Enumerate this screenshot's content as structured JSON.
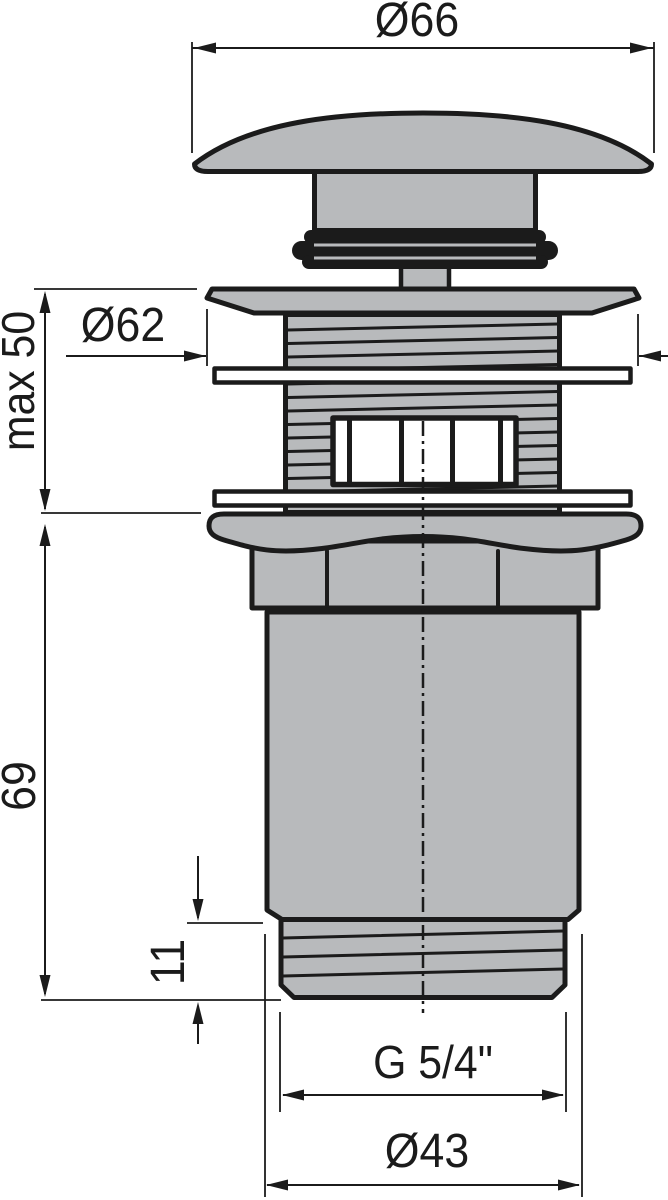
{
  "drawing": {
    "kind": "technical-dimension-drawing",
    "view": "front-section"
  },
  "dimensions": {
    "cap_diameter": {
      "label": "Ø66"
    },
    "flange_diameter": {
      "label": "Ø62"
    },
    "max_mount_thickness": {
      "label": "max 50"
    },
    "body_length": {
      "label": "69"
    },
    "thread_length": {
      "label": "11"
    },
    "thread_size": {
      "label": "G 5/4\""
    },
    "outlet_diameter": {
      "label": "Ø43"
    }
  },
  "colors": {
    "part_fill": "#b8babc",
    "line": "#1b1b1b",
    "background": "#ffffff"
  }
}
